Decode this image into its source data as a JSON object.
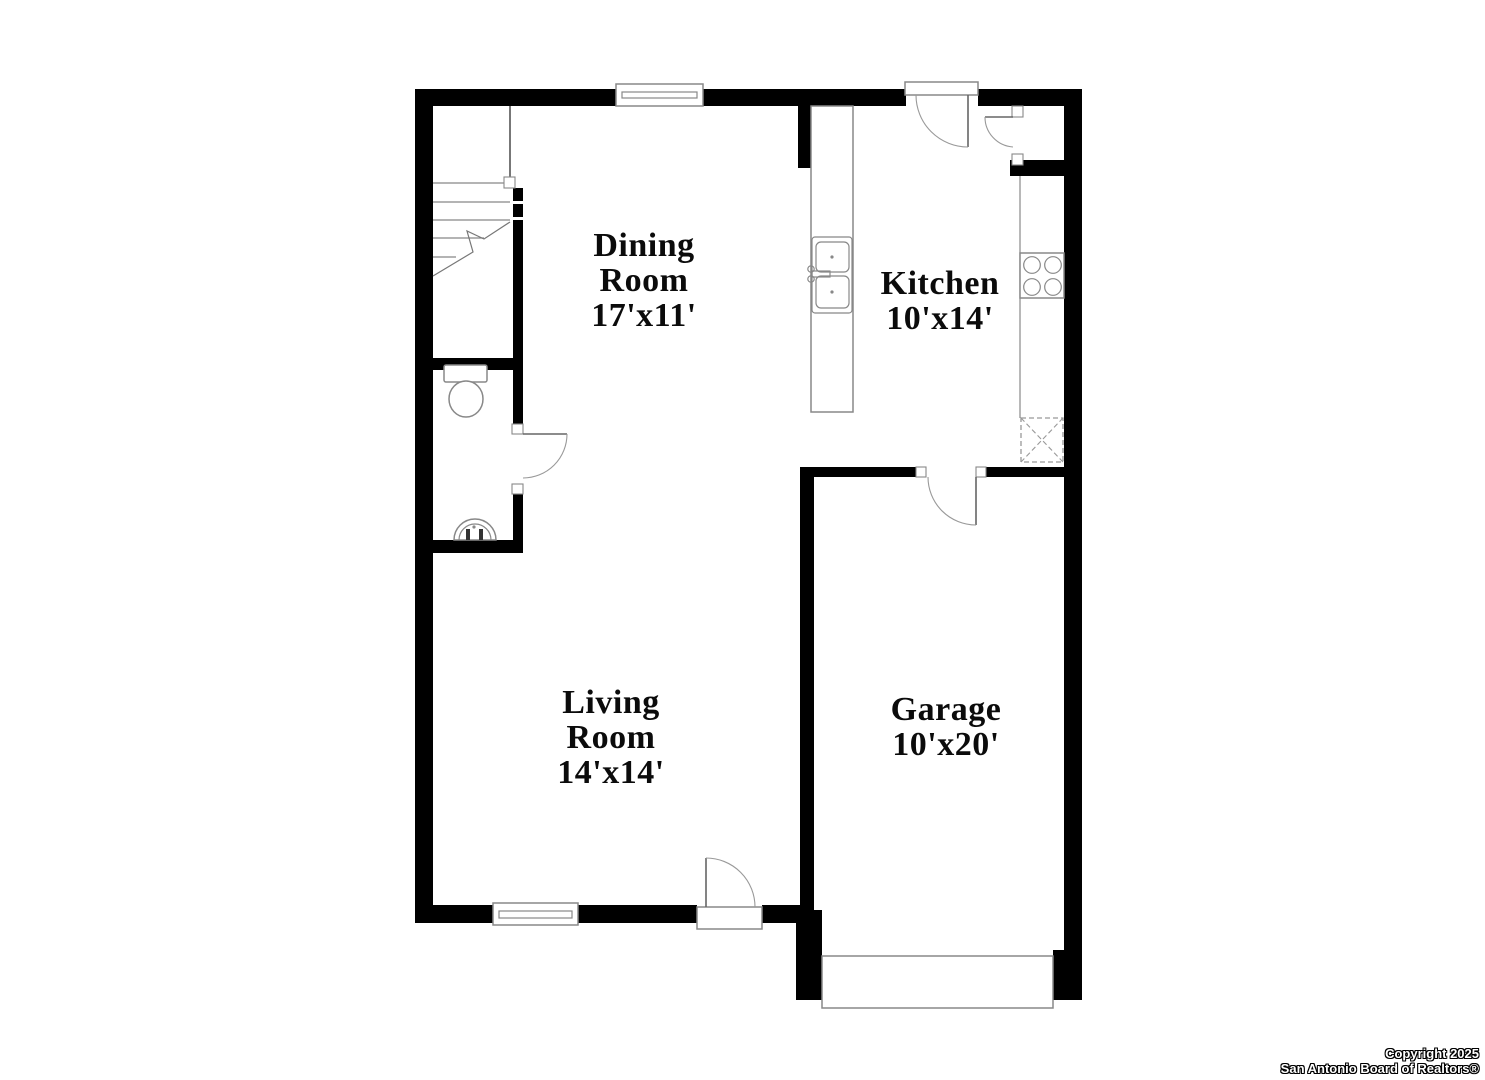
{
  "image": {
    "type": "residential-floor-plan",
    "background_color": "#ffffff",
    "wall_color": "#000000",
    "fixture_line_color": "#888888"
  },
  "rooms": {
    "dining": {
      "line1": "Dining",
      "line2": "Room",
      "dims": "17'x11'"
    },
    "kitchen": {
      "line1": "Kitchen",
      "dims": "10'x14'"
    },
    "living": {
      "line1": "Living",
      "line2": "Room",
      "dims": "14'x14'"
    },
    "garage": {
      "line1": "Garage",
      "dims": "10'x20'"
    }
  },
  "fixtures": [
    "stairs",
    "stair-railing",
    "half-bath-toilet",
    "half-bath-pedestal-sink",
    "peninsula-counter-double-sink",
    "cooktop-stove",
    "refrigerator-dashed",
    "pantry-closet",
    "dining-window",
    "living-window",
    "back-door",
    "front-door",
    "garage-entry-door",
    "bathroom-door",
    "pantry-door",
    "garage-door"
  ],
  "footer": {
    "line1": "Copyright 2025",
    "line2": "San Antonio Board of Realtors®"
  }
}
